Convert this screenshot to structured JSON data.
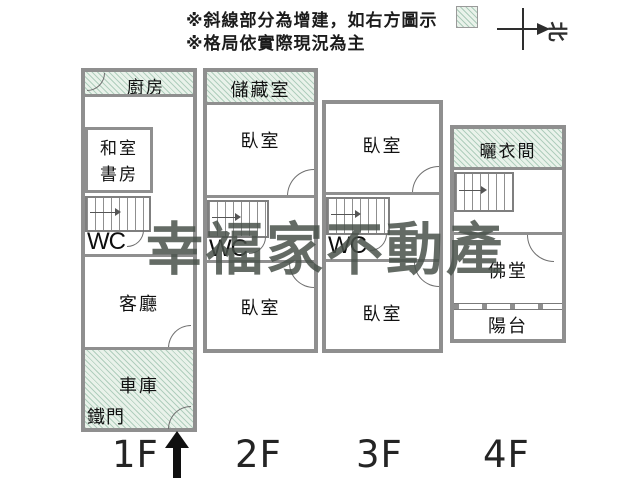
{
  "legend": {
    "line1": "※斜線部分為增建，如右方圖示",
    "line2": "※格局依實際現況為主",
    "north": "北"
  },
  "watermark": "幸福家不動產",
  "colors": {
    "wall": "#8f8f8f",
    "hatch_bg": "#e9f2ea",
    "hatch_line": "#8fc4a8",
    "watermark": "#49524b",
    "arrow": "#101010"
  },
  "floors": {
    "f1": {
      "label": "1F",
      "kitchen": "廚房",
      "study_line1": "和室",
      "study_line2": "書房",
      "wc": "WC",
      "living": "客廳",
      "garage": "車庫",
      "gate": "鐵門"
    },
    "f2": {
      "label": "2F",
      "storage": "儲藏室",
      "bed_top": "臥室",
      "wc": "WC",
      "bed_bottom": "臥室"
    },
    "f3": {
      "label": "3F",
      "bed_top": "臥室",
      "wc": "WC",
      "bed_bottom": "臥室"
    },
    "f4": {
      "label": "4F",
      "drying": "曬衣間",
      "shrine": "佛堂",
      "balcony": "陽台"
    }
  }
}
